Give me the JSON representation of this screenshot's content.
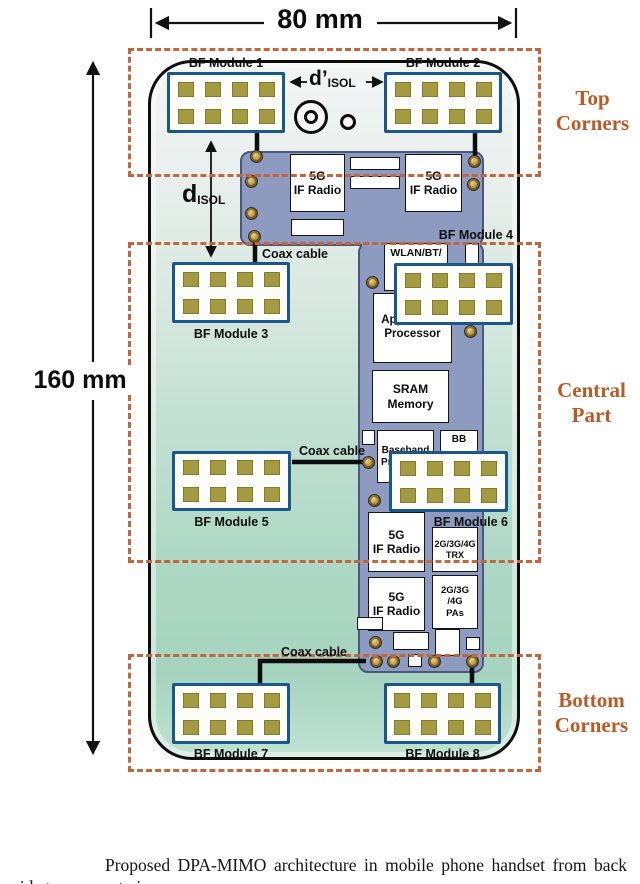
{
  "dimensions": {
    "width": "80 mm",
    "height": "160 mm",
    "d_isol": {
      "base": "d",
      "sub": "ISOL"
    },
    "d_isol_prime": {
      "base": "d’",
      "sub": "ISOL"
    }
  },
  "regions": {
    "top": {
      "line1": "Top",
      "line2": "Corners"
    },
    "central": {
      "line1": "Central",
      "line2": "Part"
    },
    "bottom": {
      "line1": "Bottom",
      "line2": "Corners"
    }
  },
  "bf_modules": [
    {
      "name": "BF Module 1"
    },
    {
      "name": "BF Module 2"
    },
    {
      "name": "BF Module 3"
    },
    {
      "name": "BF Module 4"
    },
    {
      "name": "BF Module 5"
    },
    {
      "name": "BF Module 6"
    },
    {
      "name": "BF Module 7"
    },
    {
      "name": "BF Module 8"
    }
  ],
  "coax_labels": [
    "Coax cable",
    "Coax cable",
    "Coax cable"
  ],
  "chips": {
    "if_radio_top_left": {
      "line1": "5G",
      "line2": "IF Radio"
    },
    "if_radio_top_right": {
      "line1": "5G",
      "line2": "IF Radio"
    },
    "wlan": {
      "line1": "WLAN/BT/"
    },
    "app_processor": {
      "line1": "Application",
      "line2": "Processor"
    },
    "sram": {
      "line1": "SRAM",
      "line2": "Memory"
    },
    "baseband": {
      "line1": "Baseband",
      "line2": "Processor"
    },
    "bb": {
      "line1": "BB"
    },
    "trx": {
      "line1": "2G/3G/4G",
      "line2": "TRX"
    },
    "if_radio_mid": {
      "line1": "5G",
      "line2": "IF Radio"
    },
    "if_radio_bottom": {
      "line1": "5G",
      "line2": "IF Radio"
    },
    "pas": {
      "line1": "2G/3G",
      "line2": "/4G",
      "line3": "PAs"
    }
  },
  "caption": "Proposed DPA-MIMO architecture in mobile phone handset from back side transparent view.",
  "colors": {
    "pcb": "#8c9bbf",
    "module_border": "#1a578c",
    "antenna_pad": "#a49a42",
    "region_dash": "#c4663a",
    "region_label_text": "#bc5a26",
    "phone_gradient_top": "#f3f5f5",
    "phone_gradient_bottom": "#a6d4bf"
  }
}
